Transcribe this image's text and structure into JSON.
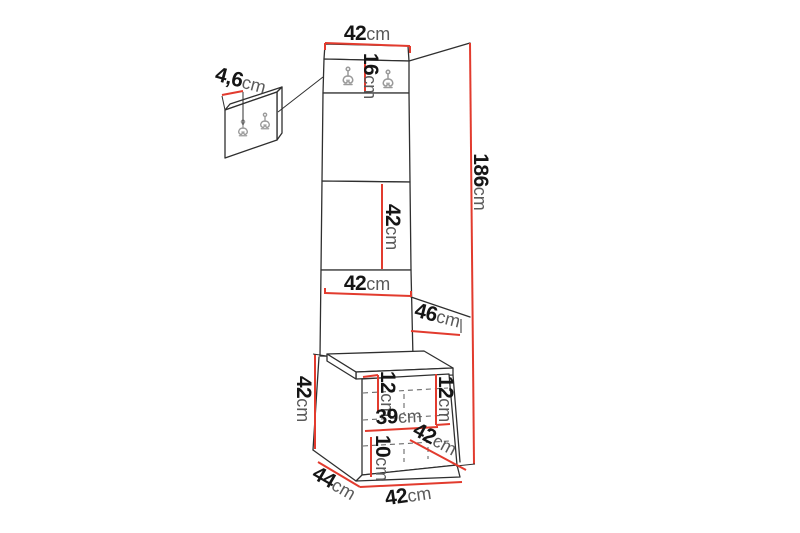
{
  "colors": {
    "line": "#2f2f2f",
    "dimension": "#e23b2e",
    "hook": "#9a9a9a",
    "num": "#151515",
    "unit": "#5a5a5a",
    "background": "#ffffff"
  },
  "dimensions": {
    "top_width": {
      "num": "42",
      "unit": "cm"
    },
    "hook_panel_height": {
      "num": "16",
      "unit": "cm"
    },
    "wall_panel_hook_spacing": {
      "num": "4,6",
      "unit": "cm"
    },
    "total_height": {
      "num": "186",
      "unit": "cm"
    },
    "mid_panel_height": {
      "num": "42",
      "unit": "cm"
    },
    "panel_width": {
      "num": "42",
      "unit": "cm"
    },
    "upper_depth": {
      "num": "46",
      "unit": "cm"
    },
    "bench_height": {
      "num": "42",
      "unit": "cm"
    },
    "bench_inner_left_height": {
      "num": "12",
      "unit": "cm"
    },
    "bench_inner_right_height": {
      "num": "12",
      "unit": "cm"
    },
    "bench_inner_width": {
      "num": "39",
      "unit": "cm"
    },
    "bench_inner_bottom_height": {
      "num": "10",
      "unit": "cm"
    },
    "bench_inner_diagonal": {
      "num": "42",
      "unit": "cm"
    },
    "bench_depth": {
      "num": "44",
      "unit": "cm"
    },
    "bench_width": {
      "num": "42",
      "unit": "cm"
    }
  }
}
